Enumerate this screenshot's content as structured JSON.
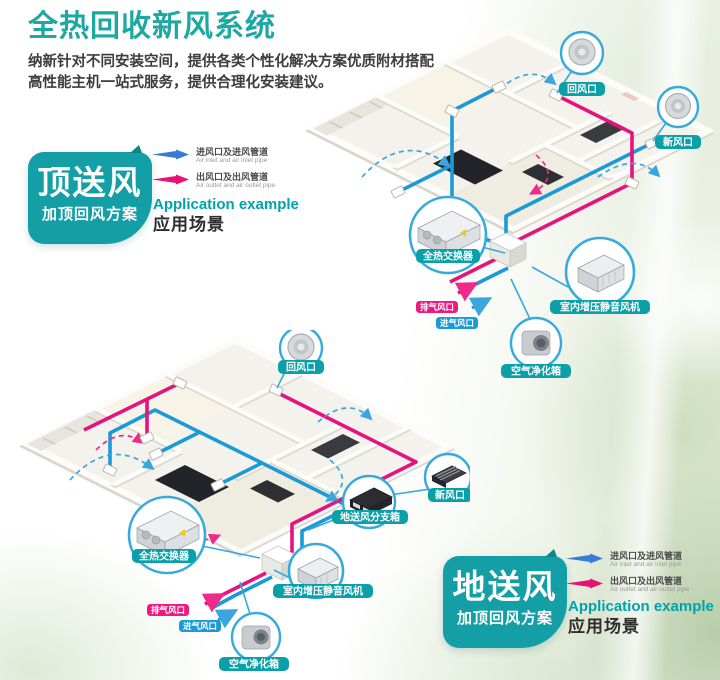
{
  "header": {
    "title": "全热回收新风系统",
    "desc_line1": "纳新针对不同安装空间，提供各类个性化解决方案优质附材搭配",
    "desc_line2": "高性能主机一站式服务，提供合理化安装建议。"
  },
  "legend": {
    "inlet_cn": "进风口及进风管道",
    "inlet_en": "Air inlet and air inlet pipe",
    "outlet_cn": "出风口及出风管道",
    "outlet_en": "Air outlet and air outlet pipe"
  },
  "application": {
    "en": "Application example",
    "cn": "应用场景"
  },
  "schemes": {
    "top": {
      "name": "顶送风",
      "sub": "加顶回风方案"
    },
    "bottom": {
      "name": "地送风",
      "sub": "加顶回风方案"
    }
  },
  "labels": {
    "return_vent": "回风口",
    "fresh_vent": "新风口",
    "heat_exchanger": "全热交换器",
    "booster_fan": "室内增压静音风机",
    "air_purifier": "空气净化箱",
    "floor_supply_box": "地送风分支箱",
    "exhaust_vent": "排气风口",
    "intake_vent": "进气风口"
  },
  "colors": {
    "title_teal": "#1ea8a2",
    "badge_teal": "#0ba0a8",
    "scheme_teal": "#149fa6",
    "duct_blue": "#1b9ad6",
    "duct_pink": "#e5137d",
    "legend_blue": "#3a7bd5",
    "legend_pink": "#e81274",
    "callout_blue": "#35aadd",
    "app_teal": "#00a2ab"
  }
}
